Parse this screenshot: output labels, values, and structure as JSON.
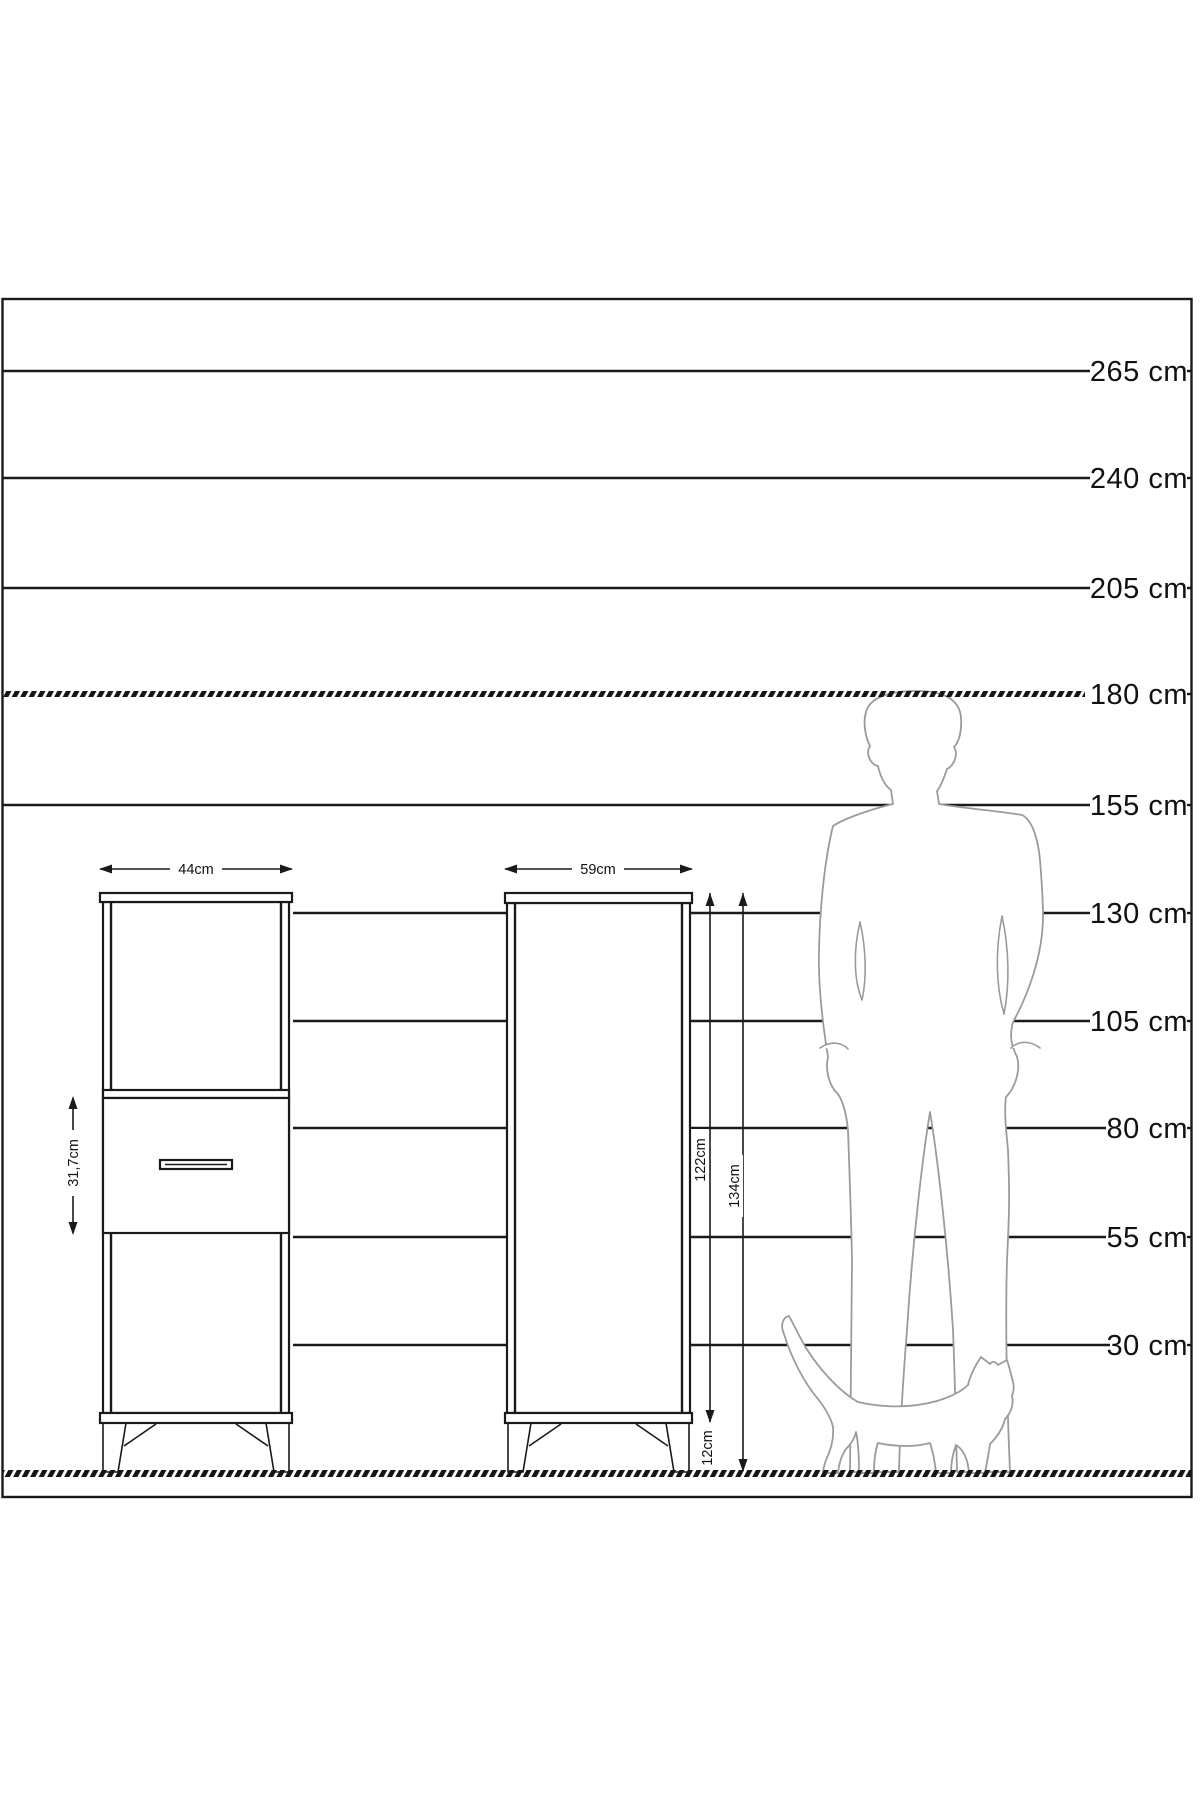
{
  "title": "furniture size scale diagram",
  "colors": {
    "line": "#1a1a1a",
    "silhouette": "#9b9b9b",
    "background": "#ffffff"
  },
  "scale_labels": [
    "265 cm",
    "240 cm",
    "205 cm",
    "180 cm",
    "155 cm",
    "130 cm",
    "105 cm",
    "80 cm",
    "55 cm",
    "30 cm"
  ],
  "dimensions": {
    "left_cabinet_width": "44cm",
    "right_cabinet_width": "59cm",
    "drawer_section_height": "31,7cm",
    "cabinet_body_height": "122cm",
    "cabinet_total_height": "134cm",
    "leg_height": "12cm"
  }
}
